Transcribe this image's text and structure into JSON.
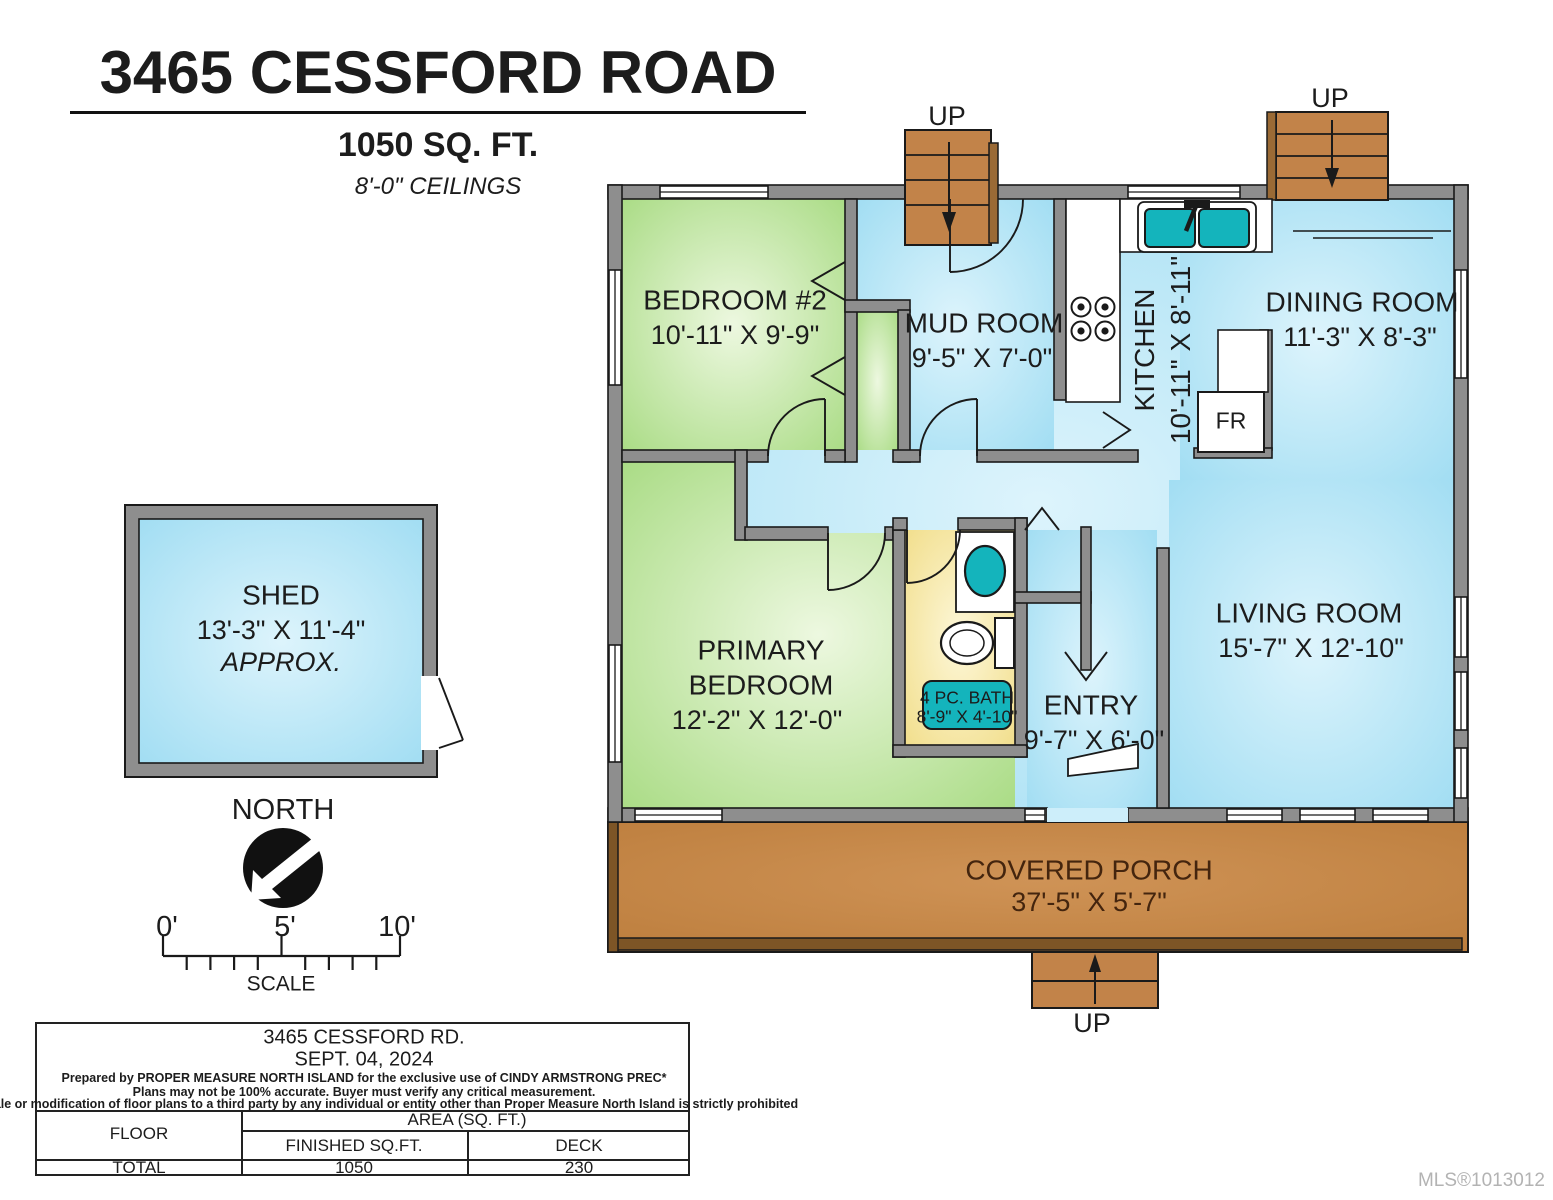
{
  "header": {
    "title": "3465 CESSFORD ROAD",
    "area": "1050 SQ. FT.",
    "ceilings": "8'-0\" CEILINGS"
  },
  "rooms": {
    "bedroom2": {
      "name": "BEDROOM #2",
      "dims": "10'-11\" X 9'-9\""
    },
    "mud_room": {
      "name": "MUD ROOM",
      "dims": "9'-5\" X 7'-0\""
    },
    "kitchen": {
      "name": "KITCHEN",
      "dims": "10'-11\" X 8'-11\""
    },
    "dining_room": {
      "name": "DINING ROOM",
      "dims": "11'-3\" X 8'-3\""
    },
    "living_room": {
      "name": "LIVING ROOM",
      "dims": "15'-7\" X 12'-10\""
    },
    "primary_bedroom": {
      "line1": "PRIMARY",
      "line2": "BEDROOM",
      "dims": "12'-2\" X 12'-0\""
    },
    "bath": {
      "name": "4 PC. BATH",
      "dims": "8'-9\" X 4'-10\""
    },
    "entry": {
      "name": "ENTRY",
      "dims": "9'-7\" X 6'-0\""
    },
    "covered_porch": {
      "name": "COVERED PORCH",
      "dims": "37'-5\" X 5'-7\""
    },
    "shed": {
      "name": "SHED",
      "dims": "13'-3\" X 11'-4\"",
      "note": "APPROX."
    }
  },
  "labels": {
    "up": "UP",
    "north": "NORTH",
    "scale": "SCALE",
    "fridge": "FR",
    "tick0": "0'",
    "tick5": "5'",
    "tick10": "10'"
  },
  "footer": {
    "address": "3465 CESSFORD RD.",
    "date": "SEPT. 04, 2024",
    "line1": "Prepared by PROPER MEASURE NORTH ISLAND for the exclusive use of CINDY ARMSTRONG PREC*",
    "line2": "Plans may not be 100% accurate.  Buyer must verify any critical measurement.",
    "line3": "Private resale  or modification of floor plans to a third party by any individual or entity other than Proper Measure North Island is strictly prohibited",
    "table": {
      "floor": "FLOOR",
      "area_header": "AREA (SQ. FT.)",
      "finished": "FINISHED SQ.FT.",
      "deck": "DECK",
      "total": "TOTAL",
      "finished_value": "1050",
      "deck_value": "230"
    }
  },
  "watermark": "MLS®1013012",
  "colors": {
    "wall": "#8e8e8e",
    "blue_edge": "#9edcf2",
    "blue_center": "#ddf4fc",
    "green_edge": "#a6da80",
    "green_center": "#edf8e0",
    "yellow_edge": "#f0db82",
    "yellow_center": "#fdf7d8",
    "porch": "#c2823f",
    "porch_light": "#cf9356",
    "porch_rim": "#7d5526",
    "stairs": "#c28349",
    "teal": "#14b4bc",
    "line": "#1a1a1a"
  }
}
